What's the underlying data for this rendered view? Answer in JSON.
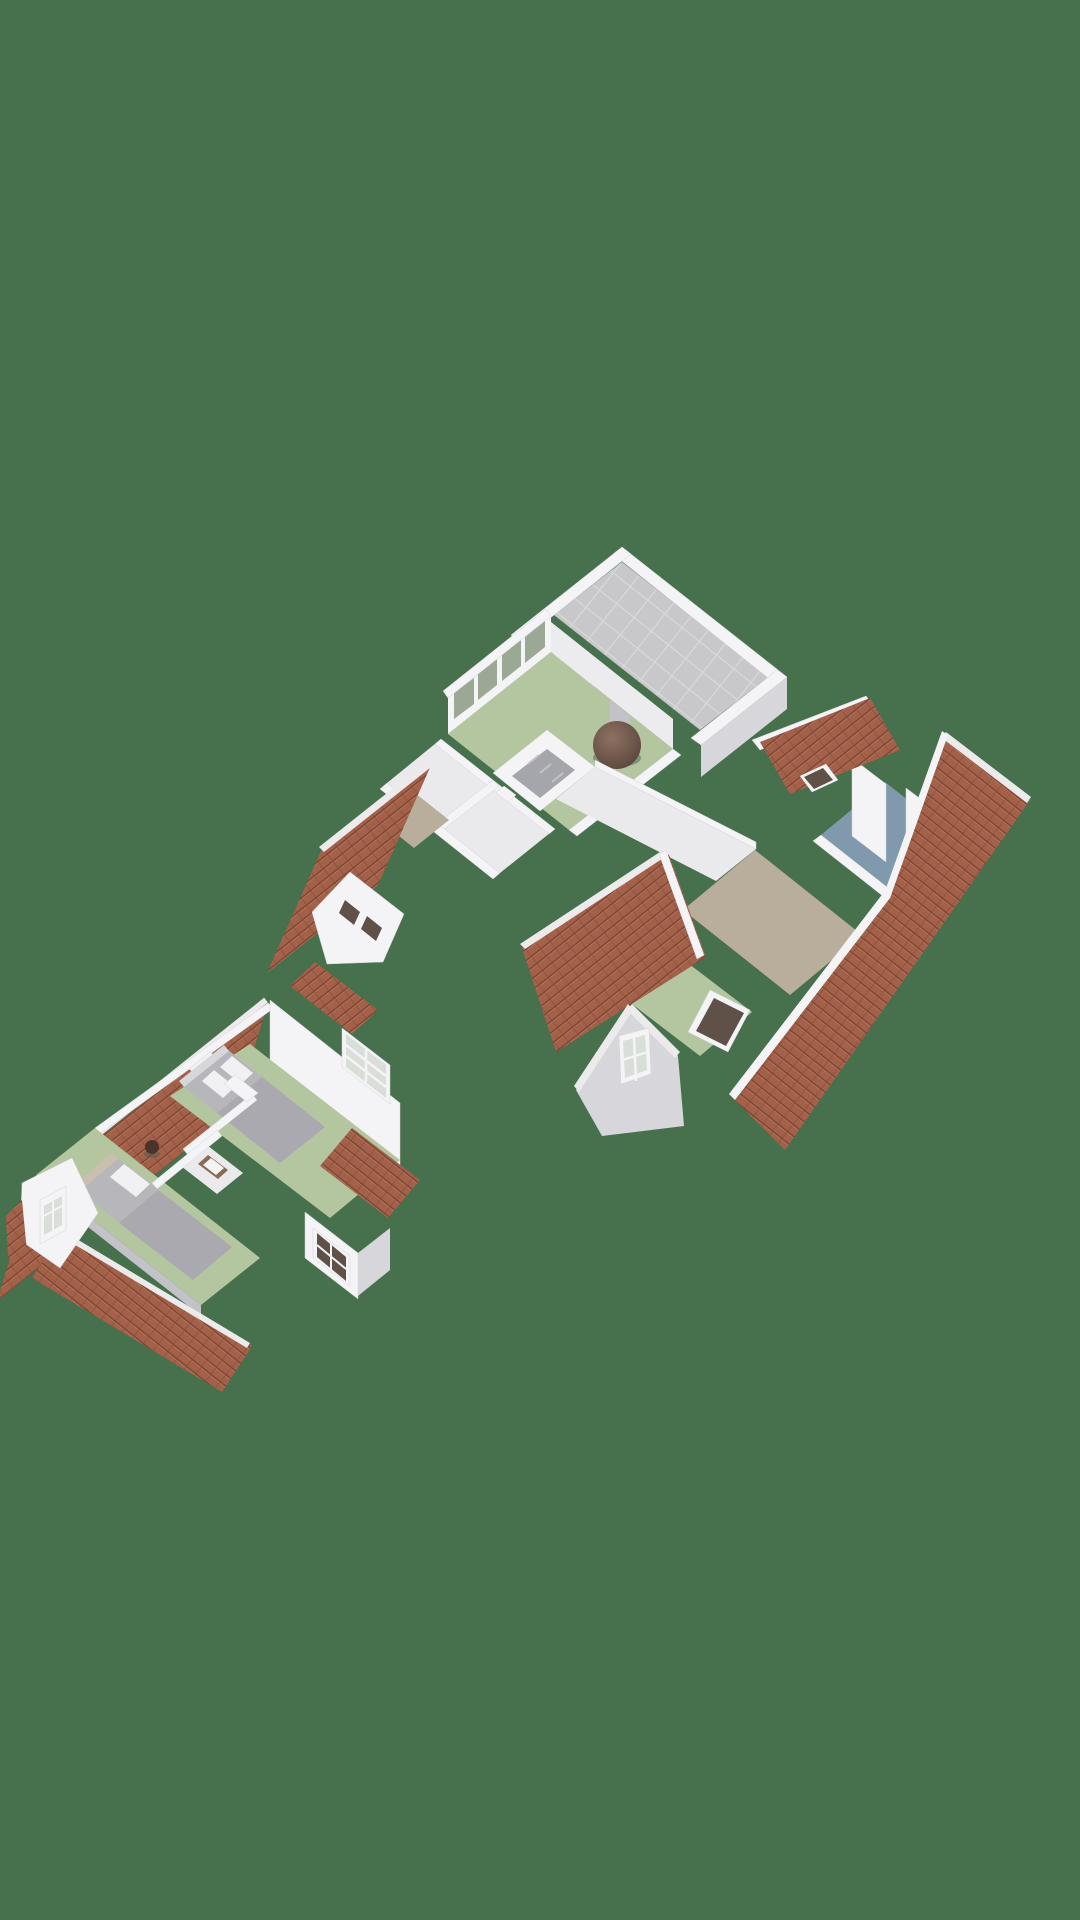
{
  "scene": {
    "description": "3D isometric floor plan rendering of two storeys of a house on a plain green background",
    "background": "#47704d"
  },
  "palette": {
    "background": "#47704d",
    "wall_white": "#f4f4f6",
    "wall_light": "#ececef",
    "wall_shade": "#d6d6db",
    "wall_dark": "#c2c2c8",
    "floor_green": "#b4c6a0",
    "floor_white": "#eaeaed",
    "floor_taupe": "#b9ad9c",
    "floor_blue": "#8199ad",
    "terrace_tile": "#c8c8ca",
    "terrace_joint": "#d9d9db",
    "roof_base": "#a4614a",
    "roof_line": "#7f4836",
    "roof_light": "#b7755d",
    "ridge_white": "#eceaea",
    "glass_green": "#9aa894",
    "glass_gray": "#d9ded8",
    "glass_dark": "#5f5148",
    "stair_dark": "#a5a5ac",
    "bed_gray": "#b7b7bb",
    "bed_blanket": "#a9a9af",
    "pillow": "#f1f1f3",
    "headboard": "#c9bfae",
    "wood": "#8a6a52",
    "beanbag_hi": "#8d7263",
    "beanbag_lo": "#59443a",
    "stool": "#4a342c",
    "shadow": "#3a5c40"
  },
  "floorplans": [
    {
      "id": "upper-floor",
      "rooms": [
        "roof-terrace",
        "bedroom-front",
        "hallway",
        "stairwell",
        "landing",
        "bathroom-blue",
        "bedroom-rear"
      ],
      "objects": [
        "beanbag",
        "dormer-window-band",
        "roof-skylights",
        "gable-windows",
        "red-tile-roofs"
      ]
    },
    {
      "id": "attic-floor",
      "rooms": [
        "bedroom-left",
        "bedroom-right",
        "bathroom-small"
      ],
      "objects": [
        "double-bed",
        "single-bed",
        "crib",
        "stool",
        "washbasin",
        "dormer-window",
        "gable-window",
        "red-tile-roofs"
      ]
    }
  ]
}
